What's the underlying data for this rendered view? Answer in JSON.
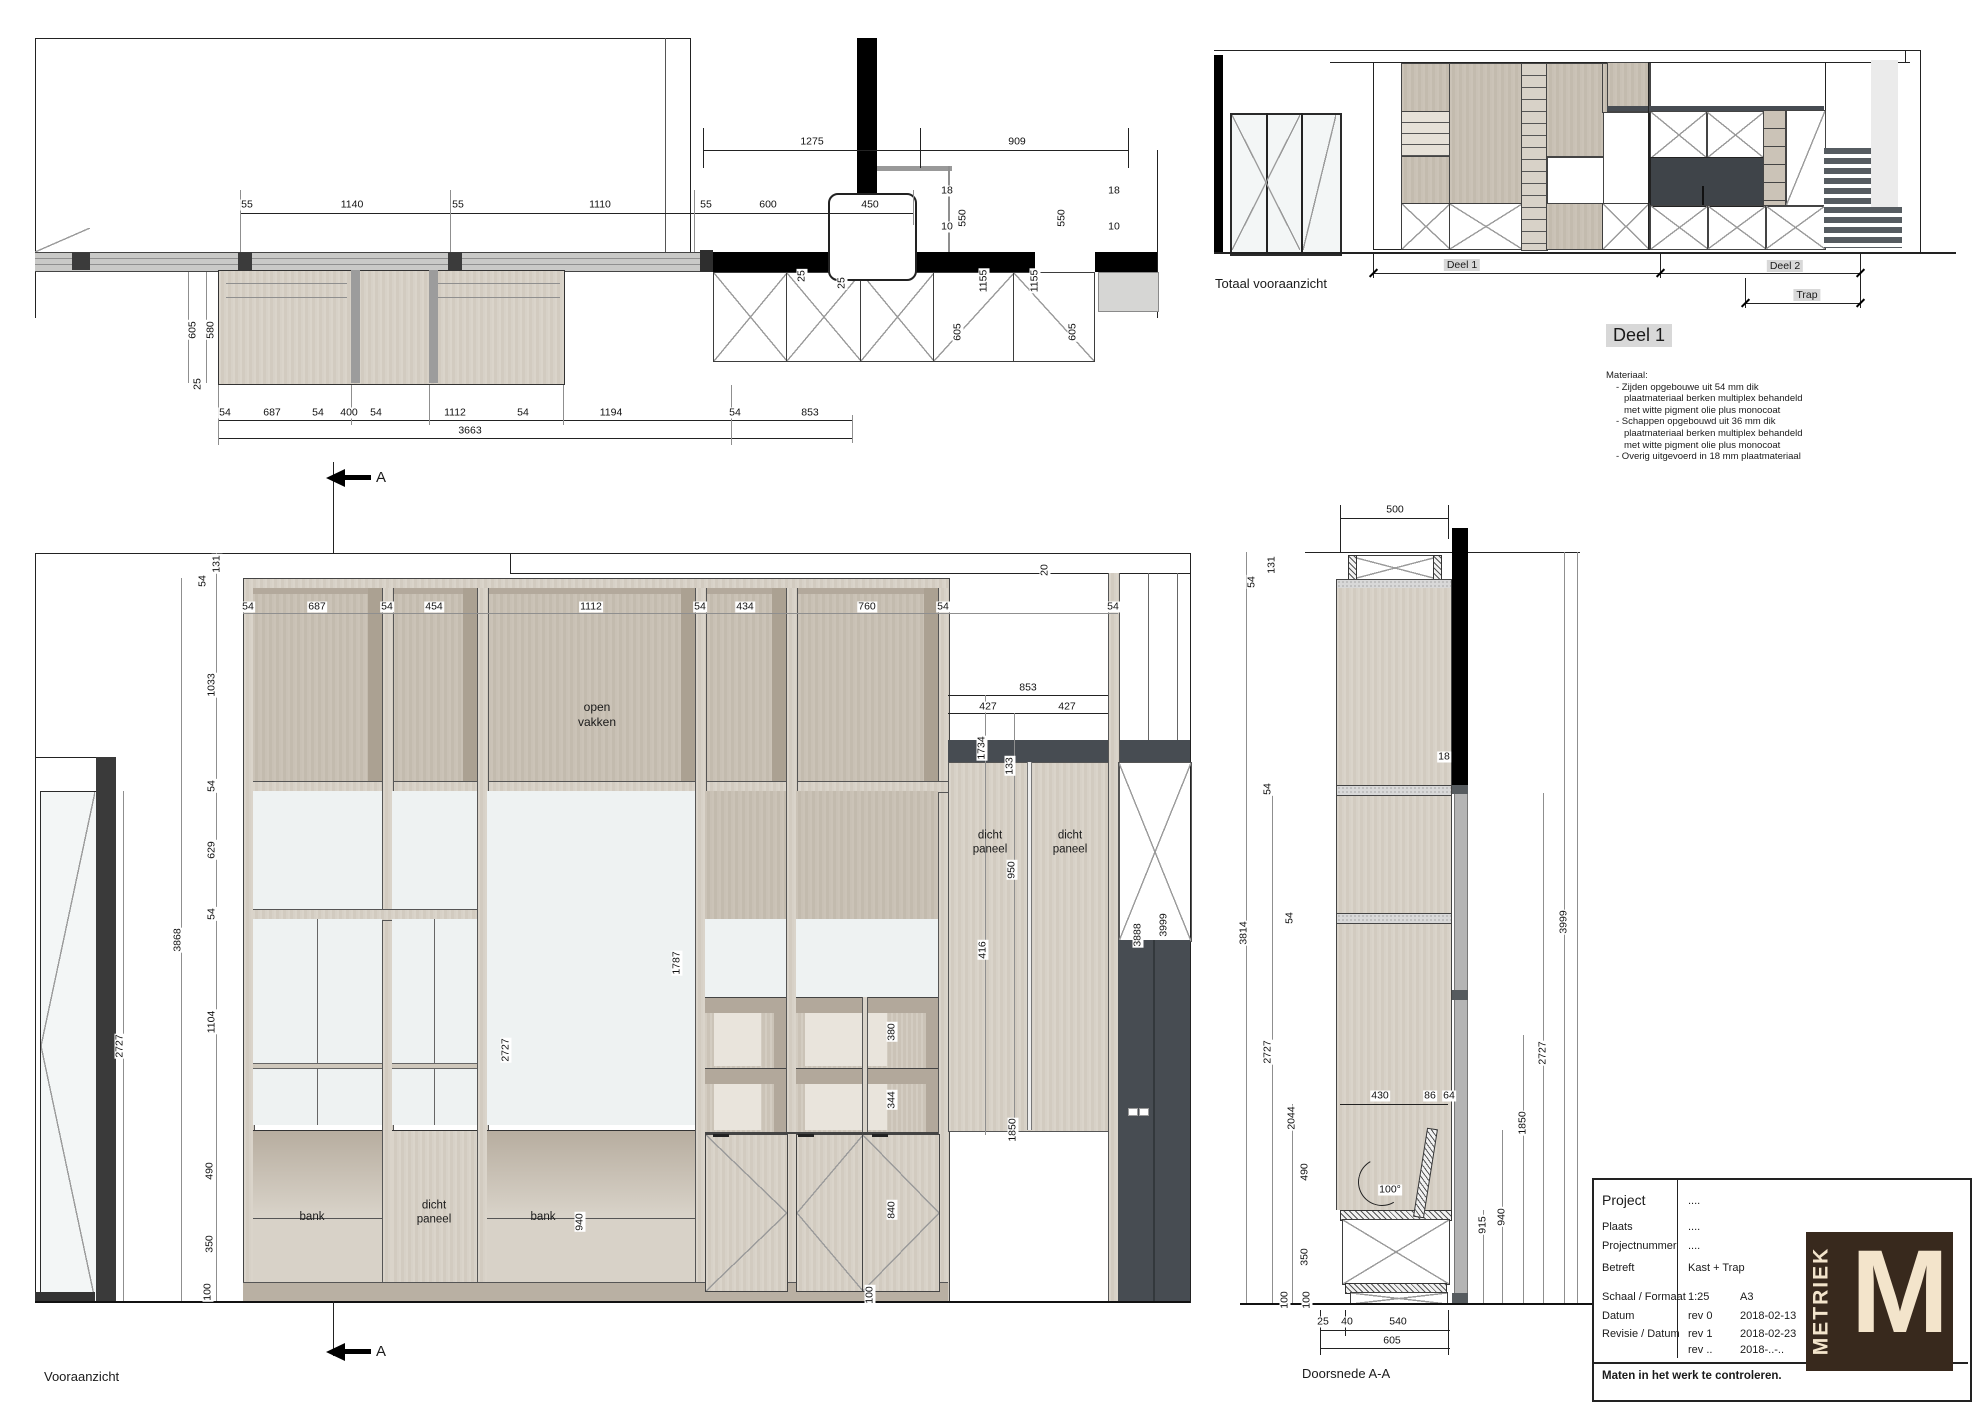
{
  "plan": {
    "dims": [
      {
        "t": "1275",
        "x": 812,
        "y": 142
      },
      {
        "t": "909",
        "x": 1017,
        "y": 142
      },
      {
        "t": "55",
        "x": 247,
        "y": 205
      },
      {
        "t": "1140",
        "x": 352,
        "y": 205
      },
      {
        "t": "55",
        "x": 458,
        "y": 205
      },
      {
        "t": "1110",
        "x": 600,
        "y": 205
      },
      {
        "t": "55",
        "x": 706,
        "y": 205
      },
      {
        "t": "600",
        "x": 768,
        "y": 205
      },
      {
        "t": "450",
        "x": 870,
        "y": 205
      },
      {
        "t": "18",
        "x": 947,
        "y": 191
      },
      {
        "t": "10",
        "x": 947,
        "y": 227
      },
      {
        "t": "550",
        "x": 963,
        "y": 218,
        "r": 1
      },
      {
        "t": "550",
        "x": 1062,
        "y": 218,
        "r": 1
      },
      {
        "t": "18",
        "x": 1114,
        "y": 191
      },
      {
        "t": "10",
        "x": 1114,
        "y": 227
      },
      {
        "t": "1155",
        "x": 984,
        "y": 281,
        "r": 1
      },
      {
        "t": "1155",
        "x": 1035,
        "y": 281,
        "r": 1
      },
      {
        "t": "605",
        "x": 958,
        "y": 332,
        "r": 1
      },
      {
        "t": "605",
        "x": 1073,
        "y": 332,
        "r": 1
      },
      {
        "t": "605",
        "x": 193,
        "y": 330,
        "r": 1
      },
      {
        "t": "580",
        "x": 211,
        "y": 330,
        "r": 1
      },
      {
        "t": "25",
        "x": 198,
        "y": 384,
        "r": 1
      },
      {
        "t": "25",
        "x": 802,
        "y": 276,
        "r": 1
      },
      {
        "t": "25",
        "x": 842,
        "y": 283,
        "r": 1
      },
      {
        "t": "54",
        "x": 225,
        "y": 413
      },
      {
        "t": "687",
        "x": 272,
        "y": 413
      },
      {
        "t": "54",
        "x": 318,
        "y": 413
      },
      {
        "t": "400",
        "x": 349,
        "y": 413
      },
      {
        "t": "54",
        "x": 376,
        "y": 413
      },
      {
        "t": "1112",
        "x": 455,
        "y": 413
      },
      {
        "t": "54",
        "x": 523,
        "y": 413
      },
      {
        "t": "1194",
        "x": 611,
        "y": 413
      },
      {
        "t": "54",
        "x": 735,
        "y": 413
      },
      {
        "t": "853",
        "x": 810,
        "y": 413
      },
      {
        "t": "3663",
        "x": 470,
        "y": 431
      }
    ]
  },
  "totaal": {
    "caption": "Totaal vooraanzicht",
    "deel1": "Deel 1",
    "deel2": "Deel 2",
    "trap": "Trap"
  },
  "deel1_block": {
    "title": "Deel 1",
    "lines": [
      "Materiaal:",
      "- Zijden opgebouwe uit 54 mm dik",
      "plaatmateriaal berken multiplex behandeld",
      "met witte pigment olie plus monocoat",
      "- Schappen opgebouwd uit 36 mm dik",
      "plaatmateriaal berken multiplex behandeld",
      "met witte pigment olie plus monocoat",
      "- Overig uitgevoerd in 18 mm plaatmateriaal"
    ]
  },
  "front": {
    "caption": "Vooraanzicht",
    "section_letter": "A",
    "labels": {
      "open_vakken": "open\nvakken",
      "dicht_paneel": "dicht\npaneel",
      "bank": "bank"
    },
    "dims": [
      {
        "t": "131",
        "x": 217,
        "y": 564,
        "r": 1
      },
      {
        "t": "54",
        "x": 203,
        "y": 581,
        "r": 1
      },
      {
        "t": "54",
        "x": 248,
        "y": 607
      },
      {
        "t": "687",
        "x": 317,
        "y": 607
      },
      {
        "t": "54",
        "x": 387,
        "y": 607
      },
      {
        "t": "454",
        "x": 434,
        "y": 607
      },
      {
        "t": "1112",
        "x": 591,
        "y": 607
      },
      {
        "t": "54",
        "x": 700,
        "y": 607
      },
      {
        "t": "434",
        "x": 745,
        "y": 607
      },
      {
        "t": "760",
        "x": 867,
        "y": 607
      },
      {
        "t": "54",
        "x": 943,
        "y": 607
      },
      {
        "t": "54",
        "x": 1113,
        "y": 607
      },
      {
        "t": "1033",
        "x": 212,
        "y": 685,
        "r": 1
      },
      {
        "t": "54",
        "x": 212,
        "y": 786,
        "r": 1
      },
      {
        "t": "629",
        "x": 212,
        "y": 850,
        "r": 1
      },
      {
        "t": "54",
        "x": 212,
        "y": 914,
        "r": 1
      },
      {
        "t": "1104",
        "x": 212,
        "y": 1022,
        "r": 1
      },
      {
        "t": "490",
        "x": 210,
        "y": 1171,
        "r": 1
      },
      {
        "t": "350",
        "x": 210,
        "y": 1244,
        "r": 1
      },
      {
        "t": "100",
        "x": 208,
        "y": 1292,
        "r": 1
      },
      {
        "t": "3868",
        "x": 178,
        "y": 940,
        "r": 1
      },
      {
        "t": "2727",
        "x": 120,
        "y": 1046,
        "r": 1
      },
      {
        "t": "20",
        "x": 1045,
        "y": 570,
        "r": 1
      },
      {
        "t": "853",
        "x": 1028,
        "y": 688
      },
      {
        "t": "427",
        "x": 988,
        "y": 707
      },
      {
        "t": "427",
        "x": 1067,
        "y": 707
      },
      {
        "t": "1734",
        "x": 982,
        "y": 748,
        "r": 1
      },
      {
        "t": "133",
        "x": 1010,
        "y": 766,
        "r": 1
      },
      {
        "t": "950",
        "x": 1012,
        "y": 870,
        "r": 1
      },
      {
        "t": "416",
        "x": 983,
        "y": 950,
        "r": 1
      },
      {
        "t": "3888",
        "x": 1138,
        "y": 935,
        "r": 1
      },
      {
        "t": "3999",
        "x": 1164,
        "y": 925,
        "r": 1
      },
      {
        "t": "380",
        "x": 892,
        "y": 1032,
        "r": 1
      },
      {
        "t": "344",
        "x": 892,
        "y": 1100,
        "r": 1
      },
      {
        "t": "840",
        "x": 892,
        "y": 1210,
        "r": 1
      },
      {
        "t": "100",
        "x": 870,
        "y": 1295,
        "r": 1
      },
      {
        "t": "1850",
        "x": 1013,
        "y": 1130,
        "r": 1
      },
      {
        "t": "2727",
        "x": 506,
        "y": 1050,
        "r": 1
      },
      {
        "t": "1787",
        "x": 677,
        "y": 963,
        "r": 1
      },
      {
        "t": "940",
        "x": 580,
        "y": 1222,
        "r": 1
      }
    ]
  },
  "section": {
    "caption": "Doorsnede A-A",
    "dims": [
      {
        "t": "500",
        "x": 1395,
        "y": 510
      },
      {
        "t": "131",
        "x": 1272,
        "y": 565,
        "r": 1
      },
      {
        "t": "54",
        "x": 1252,
        "y": 582,
        "r": 1
      },
      {
        "t": "18",
        "x": 1444,
        "y": 757
      },
      {
        "t": "54",
        "x": 1268,
        "y": 789,
        "r": 1
      },
      {
        "t": "54",
        "x": 1290,
        "y": 918,
        "r": 1
      },
      {
        "t": "3814",
        "x": 1244,
        "y": 933,
        "r": 1
      },
      {
        "t": "2727",
        "x": 1268,
        "y": 1052,
        "r": 1
      },
      {
        "t": "2044",
        "x": 1292,
        "y": 1118,
        "r": 1
      },
      {
        "t": "490",
        "x": 1305,
        "y": 1172,
        "r": 1
      },
      {
        "t": "350",
        "x": 1305,
        "y": 1257,
        "r": 1
      },
      {
        "t": "100",
        "x": 1285,
        "y": 1300,
        "r": 1
      },
      {
        "t": "100",
        "x": 1307,
        "y": 1300,
        "r": 1
      },
      {
        "t": "430",
        "x": 1380,
        "y": 1096
      },
      {
        "t": "86",
        "x": 1430,
        "y": 1096
      },
      {
        "t": "64",
        "x": 1449,
        "y": 1096
      },
      {
        "t": "100°",
        "x": 1390,
        "y": 1190
      },
      {
        "t": "915",
        "x": 1483,
        "y": 1225,
        "r": 1
      },
      {
        "t": "940",
        "x": 1502,
        "y": 1217,
        "r": 1
      },
      {
        "t": "1850",
        "x": 1523,
        "y": 1123,
        "r": 1
      },
      {
        "t": "2727",
        "x": 1543,
        "y": 1053,
        "r": 1
      },
      {
        "t": "3999",
        "x": 1564,
        "y": 922,
        "r": 1
      },
      {
        "t": "25",
        "x": 1323,
        "y": 1322
      },
      {
        "t": "40",
        "x": 1347,
        "y": 1322
      },
      {
        "t": "540",
        "x": 1398,
        "y": 1322
      },
      {
        "t": "605",
        "x": 1392,
        "y": 1341
      }
    ]
  },
  "titleblock": {
    "rows": [
      {
        "label": "Project",
        "v1": "....",
        "v2": ""
      },
      {
        "label": "Plaats",
        "v1": "....",
        "v2": ""
      },
      {
        "label": "Projectnummer",
        "v1": "....",
        "v2": ""
      },
      {
        "label": "Betreft",
        "v1": "Kast + Trap",
        "v2": ""
      },
      {
        "label": "Schaal / Formaat",
        "v1": "1:25",
        "v2": "A3"
      },
      {
        "label": "Datum",
        "v1": "rev 0",
        "v2": "2018-02-13"
      },
      {
        "label": "Revisie / Datum",
        "v1": "rev 1",
        "v2": "2018-02-23"
      },
      {
        "label": "",
        "v1": "rev ..",
        "v2": "2018-..-.."
      }
    ],
    "footer": "Maten in het werk te controleren.",
    "logo": {
      "letter": "M",
      "text": "METRIEK"
    }
  }
}
